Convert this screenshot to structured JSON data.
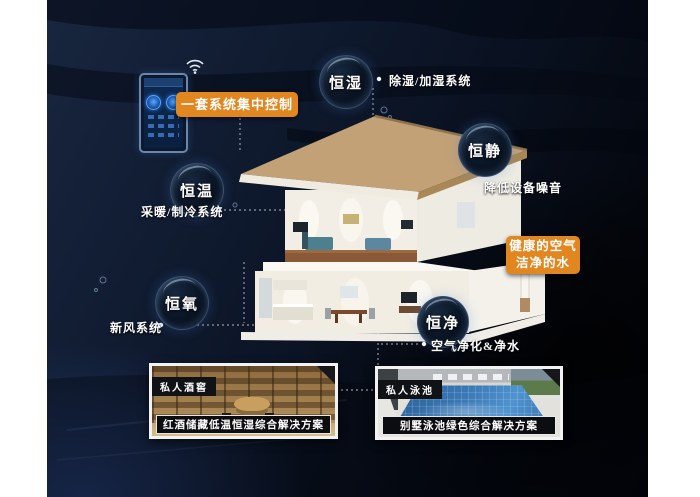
{
  "control": {
    "label": "一套系统集中控制"
  },
  "bubbles": [
    {
      "label": "恒湿",
      "note": "除湿/加湿系统"
    },
    {
      "label": "恒静",
      "note": "降低设备噪音"
    },
    {
      "label": "恒温",
      "note": "采暖/制冷系统"
    },
    {
      "label": "恒氧",
      "note": "新风系统"
    },
    {
      "label": "恒净",
      "note": "空气净化&净水"
    }
  ],
  "highlight": {
    "line1": "健康的空气",
    "line2": "洁净的水"
  },
  "photos": [
    {
      "tag": "私人酒窖",
      "caption": "红酒储藏低温恒湿综合解决方案"
    },
    {
      "tag": "私人泳池",
      "caption": "别墅泳池绿色综合解决方案"
    }
  ],
  "colors": {
    "accent_orange": "#e2861f",
    "background_navy": "#101b30",
    "bubble_border_glow": "#96bef0",
    "roof_tan": "#c3a176",
    "pool_blue": "#3a77b4"
  }
}
